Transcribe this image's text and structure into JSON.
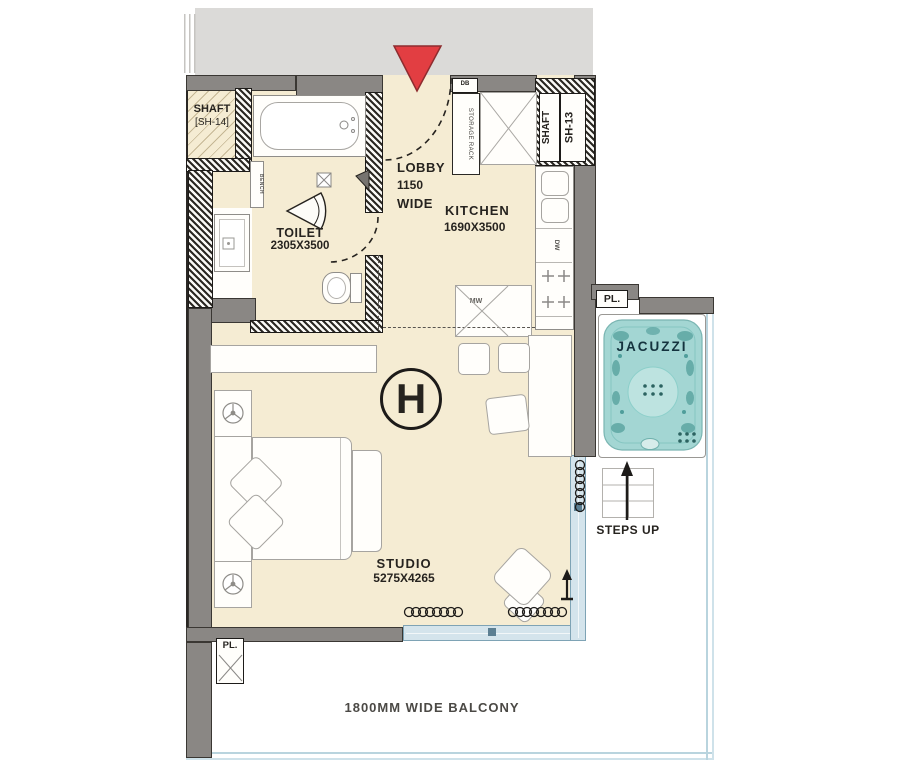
{
  "unit": {
    "marker": "H"
  },
  "rooms": {
    "shaft14": {
      "name": "SHAFT",
      "code": "[SH-14]"
    },
    "shaft13": {
      "name": "SHAFT",
      "code": "SH-13"
    },
    "toilet": {
      "name": "TOILET",
      "dims": "2305X3500"
    },
    "lobby": {
      "name": "LOBBY",
      "width_value": "1150",
      "width_word": "WIDE"
    },
    "kitchen": {
      "name": "KITCHEN",
      "dims": "1690X3500"
    },
    "studio": {
      "name": "STUDIO",
      "dims": "5275X4265"
    },
    "balcony": {
      "label": "1800MM WIDE BALCONY"
    },
    "terrace": {
      "jacuzzi": "JACUZZI",
      "steps": "STEPS UP"
    }
  },
  "fixtures": {
    "storage_rack": "STORAGE RACK",
    "db": "DB",
    "dishwasher": "DW",
    "microwave": "MW",
    "bench": "BENCH",
    "planter": "PL."
  },
  "colors": {
    "floor": "#f5ecd3",
    "wall": "#8a8784",
    "adjacent_block": "#dbdad8",
    "glazing": "#b9d4de",
    "jacuzzi_water": "#9fd4d1",
    "entry_marker": "#e23e42",
    "ink": "#26231f"
  }
}
